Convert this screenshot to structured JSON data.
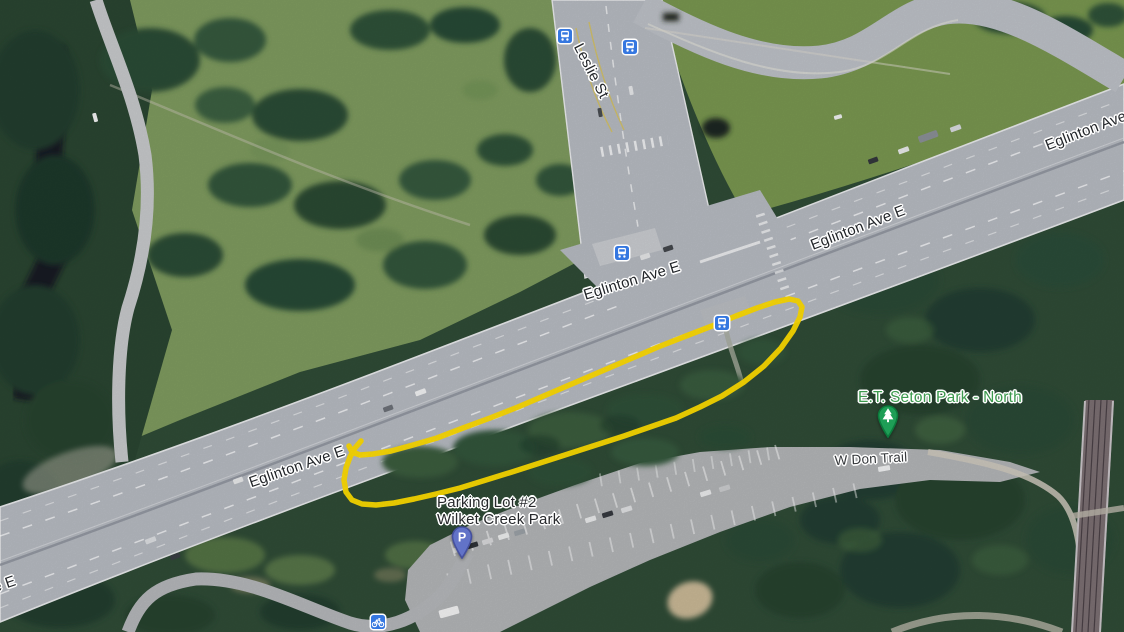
{
  "map": {
    "kind": "satellite-imagery",
    "colors": {
      "annotation_yellow": "#ffdd00",
      "transit_blue": "#3577e0",
      "parking_pin_fill": "#6273c8",
      "parking_pin_border": "#45509e",
      "park_pin_fill": "#1e9e56",
      "park_pin_border": "#0c7a3c",
      "road_label_text": "#222529",
      "place_label_text": "#27292c",
      "park_label_green": "#3d9a4e",
      "trail_label_text": "#35383b"
    }
  },
  "labels": [
    {
      "id": "leslie-st",
      "text": "Leslie St",
      "x": 591,
      "y": 71,
      "rotate": 63,
      "kind": "road",
      "size": 15,
      "color": "#222529",
      "interactable": false
    },
    {
      "id": "eglinton-ave-northeast",
      "text": "Eglinton Ave",
      "x": 1086,
      "y": 131,
      "rotate": -21,
      "kind": "road",
      "size": 15,
      "color": "#222529",
      "interactable": false
    },
    {
      "id": "eglinton-ave-e-mid",
      "text": "Eglinton Ave E",
      "x": 858,
      "y": 228,
      "rotate": -21,
      "kind": "road",
      "size": 15,
      "color": "#222529",
      "interactable": false
    },
    {
      "id": "eglinton-ave-e-center",
      "text": "Eglinton Ave E",
      "x": 632,
      "y": 281,
      "rotate": -17,
      "kind": "road",
      "size": 15,
      "color": "#222529",
      "interactable": false
    },
    {
      "id": "eglinton-ave-e-southwest",
      "text": "Eglinton Ave E",
      "x": 297,
      "y": 467,
      "rotate": -19,
      "kind": "road",
      "size": 15,
      "color": "#222529",
      "interactable": false
    },
    {
      "id": "eglinton-ave-e-corner",
      "text": "Eglinton Ave E",
      "x": -32,
      "y": 597,
      "rotate": -19,
      "kind": "road",
      "size": 15,
      "color": "#222529",
      "interactable": false
    },
    {
      "id": "parking-lot-2",
      "text": "Parking Lot #2\nWilket Creek Park",
      "x": 437,
      "y": 511,
      "rotate": 0,
      "kind": "place",
      "size": 15,
      "align": "left",
      "color": "#27292c",
      "interactable": true
    },
    {
      "id": "et-seton-park-north",
      "text": "E.T. Seton Park - North",
      "x": 940,
      "y": 398,
      "rotate": 0,
      "kind": "park",
      "size": 15.5,
      "color": "#3d9a4e",
      "interactable": true
    },
    {
      "id": "w-don-trail",
      "text": "W Don Trail",
      "x": 871,
      "y": 459,
      "rotate": -3,
      "kind": "trail",
      "size": 13.5,
      "color": "#35383b",
      "interactable": false
    }
  ],
  "markers": [
    {
      "type": "bus-stop",
      "x": 565,
      "y": 36
    },
    {
      "type": "bus-stop",
      "x": 630,
      "y": 47
    },
    {
      "type": "bus-stop",
      "x": 622,
      "y": 253
    },
    {
      "type": "bus-stop",
      "x": 722,
      "y": 323
    },
    {
      "type": "bike-parking",
      "x": 378,
      "y": 622
    },
    {
      "type": "parking-pin",
      "x": 462,
      "y": 559,
      "letter": "P"
    },
    {
      "type": "park-pin",
      "x": 888,
      "y": 438
    }
  ],
  "annotation": {
    "shape": "hand-drawn-loop",
    "color": "#ffdd00",
    "stroke_width": 5.5,
    "points": [
      [
        361,
        441
      ],
      [
        355,
        448
      ],
      [
        350,
        457
      ],
      [
        346,
        468
      ],
      [
        344,
        480
      ],
      [
        346,
        492
      ],
      [
        352,
        500
      ],
      [
        362,
        504
      ],
      [
        376,
        505
      ],
      [
        394,
        503
      ],
      [
        414,
        499
      ],
      [
        436,
        494
      ],
      [
        460,
        488
      ],
      [
        486,
        480
      ],
      [
        512,
        472
      ],
      [
        540,
        463
      ],
      [
        568,
        454
      ],
      [
        596,
        445
      ],
      [
        624,
        436
      ],
      [
        650,
        427
      ],
      [
        676,
        418
      ],
      [
        700,
        407
      ],
      [
        722,
        396
      ],
      [
        744,
        382
      ],
      [
        764,
        366
      ],
      [
        781,
        348
      ],
      [
        793,
        331
      ],
      [
        800,
        317
      ],
      [
        802,
        307
      ],
      [
        798,
        301
      ],
      [
        789,
        299
      ],
      [
        775,
        302
      ],
      [
        757,
        308
      ],
      [
        736,
        316
      ],
      [
        712,
        326
      ],
      [
        686,
        336
      ],
      [
        658,
        347
      ],
      [
        630,
        359
      ],
      [
        602,
        371
      ],
      [
        574,
        383
      ],
      [
        546,
        395
      ],
      [
        518,
        407
      ],
      [
        490,
        418
      ],
      [
        463,
        428
      ],
      [
        437,
        438
      ],
      [
        413,
        445
      ],
      [
        391,
        451
      ],
      [
        373,
        454
      ],
      [
        360,
        455
      ],
      [
        352,
        452
      ],
      [
        349,
        446
      ]
    ]
  }
}
